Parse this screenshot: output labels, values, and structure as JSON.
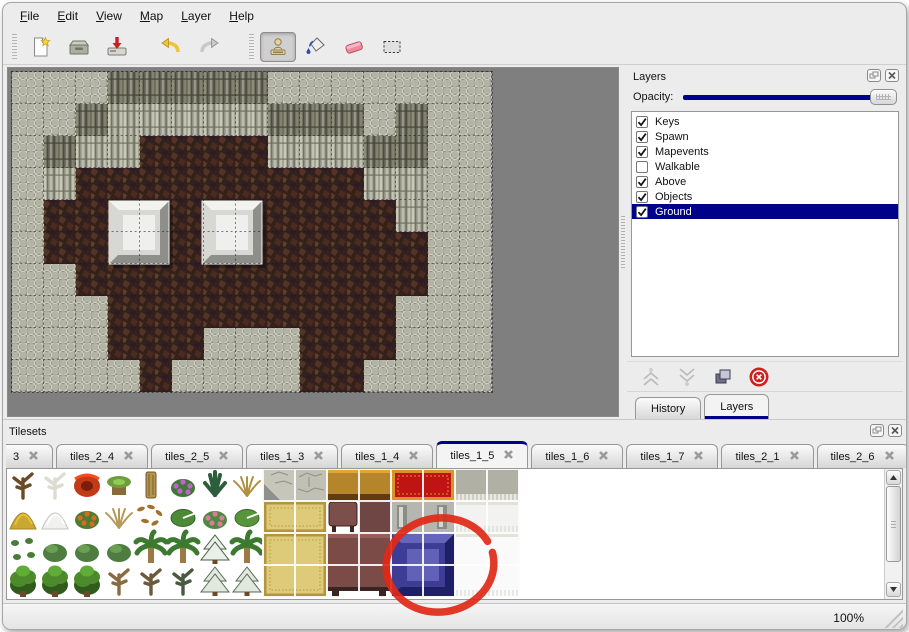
{
  "menu": {
    "items": [
      "File",
      "Edit",
      "View",
      "Map",
      "Layer",
      "Help"
    ]
  },
  "toolbar": {
    "groups": [
      [
        {
          "icon": "new-file"
        },
        {
          "icon": "open"
        },
        {
          "icon": "save"
        }
      ],
      [
        {
          "icon": "undo"
        },
        {
          "icon": "redo"
        }
      ],
      [
        {
          "icon": "stamp-tool",
          "active": true
        },
        {
          "icon": "paint-bucket-tool"
        },
        {
          "icon": "eraser-tool"
        },
        {
          "icon": "rect-select-tool"
        }
      ]
    ]
  },
  "layers_panel": {
    "title": "Layers",
    "opacity_label": "Opacity:",
    "opacity_percent": 100,
    "accent": "#00008b",
    "layers": [
      {
        "name": "Keys",
        "checked": true,
        "selected": false
      },
      {
        "name": "Spawn",
        "checked": true,
        "selected": false
      },
      {
        "name": "Mapevents",
        "checked": true,
        "selected": false
      },
      {
        "name": "Walkable",
        "checked": false,
        "selected": false
      },
      {
        "name": "Above",
        "checked": true,
        "selected": false
      },
      {
        "name": "Objects",
        "checked": true,
        "selected": false
      },
      {
        "name": "Ground",
        "checked": true,
        "selected": true
      }
    ],
    "buttons": [
      "layer-up",
      "layer-down",
      "layer-duplicate",
      "layer-delete"
    ],
    "dock_tabs": [
      {
        "label": "History",
        "active": false
      },
      {
        "label": "Layers",
        "active": true
      }
    ]
  },
  "tilesets_panel": {
    "title": "Tilesets",
    "tabs": [
      {
        "label": "3",
        "partial": true,
        "active": false
      },
      {
        "label": "tiles_2_4",
        "active": false
      },
      {
        "label": "tiles_2_5",
        "active": false
      },
      {
        "label": "tiles_1_3",
        "active": false
      },
      {
        "label": "tiles_1_4",
        "active": false
      },
      {
        "label": "tiles_1_5",
        "active": true
      },
      {
        "label": "tiles_1_6",
        "active": false
      },
      {
        "label": "tiles_1_7",
        "active": false
      },
      {
        "label": "tiles_2_1",
        "active": false
      },
      {
        "label": "tiles_2_6",
        "active": false
      }
    ]
  },
  "status_bar": {
    "zoom_level": "100%"
  },
  "map": {
    "tile_size": 32,
    "legend": {
      "S": "rough-stone-ground",
      "C": "cliff-wall",
      "D": "cliff-wall-dark",
      "B": "dark-floor"
    },
    "grid": [
      "SSSDDDDDSSSSSSS",
      "SSDCCCCCDDDSDSS",
      "SDCCBBBBCCCDDSS",
      "SCBBBBBBBBBCCSS",
      "SBBBBBBBBBBBCSS",
      "SBBBBBBBBBBBBSS",
      "SSBBBBBBBBBBBSS",
      "SSSBBBBBBBBBSSS",
      "SSSBBBSSSBBBSSS",
      "SSSSBSSSSBBSSSS"
    ],
    "blocks": [
      {
        "x": 97,
        "y": 129,
        "w": 60,
        "h": 63
      },
      {
        "x": 190,
        "y": 129,
        "w": 60,
        "h": 63
      }
    ]
  },
  "tileset": {
    "items": [
      {
        "x": 0,
        "y": 0,
        "shape": "deadtree",
        "fill": "#6b4a26"
      },
      {
        "x": 1,
        "y": 0,
        "shape": "whitetree",
        "fill": "#dcdcd2"
      },
      {
        "x": 2,
        "y": 0,
        "shape": "bigflower",
        "fill": "#c23a16",
        "fill2": "#7a1e0a"
      },
      {
        "x": 3,
        "y": 0,
        "shape": "stump",
        "fill": "#6f9c3f",
        "fill2": "#8a6a3a"
      },
      {
        "x": 4,
        "y": 0,
        "shape": "trunk",
        "fill": "#b5954e"
      },
      {
        "x": 5,
        "y": 0,
        "shape": "flowerbush",
        "fill": "#3f7a35",
        "fill2": "#c75fd4"
      },
      {
        "x": 6,
        "y": 0,
        "shape": "fern",
        "fill": "#2c5e3c"
      },
      {
        "x": 7,
        "y": 0,
        "shape": "dryplant",
        "fill": "#b08f3e"
      },
      {
        "x": 0,
        "y": 1,
        "shape": "mound",
        "fill": "#c9a733",
        "fill2": "#a8851f"
      },
      {
        "x": 1,
        "y": 1,
        "shape": "mound",
        "fill": "#f1f1ed",
        "fill2": "#c4c4c0"
      },
      {
        "x": 2,
        "y": 1,
        "shape": "flowerbush",
        "fill": "#4d7c33",
        "fill2": "#d96a22"
      },
      {
        "x": 3,
        "y": 1,
        "shape": "dryplant",
        "fill": "#b59a56"
      },
      {
        "x": 4,
        "y": 1,
        "shape": "scatter",
        "fill": "#a0702c"
      },
      {
        "x": 5,
        "y": 1,
        "shape": "pad",
        "fill": "#4c8a38"
      },
      {
        "x": 6,
        "y": 1,
        "shape": "flowerbush",
        "fill": "#4c8a44",
        "fill2": "#e07898"
      },
      {
        "x": 7,
        "y": 1,
        "shape": "pad",
        "fill": "#57953c"
      },
      {
        "x": 0,
        "y": 2,
        "shape": "sprouts",
        "fill": "#4a7c38"
      },
      {
        "x": 1,
        "y": 2,
        "shape": "bush",
        "fill": "#4f7c40"
      },
      {
        "x": 2,
        "y": 2,
        "shape": "bush",
        "fill": "#4f7c40"
      },
      {
        "x": 3,
        "y": 2,
        "shape": "bush",
        "fill": "#4f7c40"
      },
      {
        "x": 4,
        "y": 2,
        "shape": "palm",
        "fill": "#3c7a30",
        "fill2": "#9a7a46"
      },
      {
        "x": 5,
        "y": 2,
        "shape": "palm",
        "fill": "#3c7a30",
        "fill2": "#9a7a46"
      },
      {
        "x": 6,
        "y": 2,
        "shape": "snowtree",
        "fill": "#e9efe9",
        "fill2": "#49603f"
      },
      {
        "x": 7,
        "y": 2,
        "shape": "palm",
        "fill": "#3c7a30",
        "fill2": "#9a7a46"
      },
      {
        "x": 0,
        "y": 3,
        "shape": "tree",
        "fill": "#4c8a2c",
        "fill2": "#2f5c1c"
      },
      {
        "x": 1,
        "y": 3,
        "shape": "tree",
        "fill": "#4c8a2c",
        "fill2": "#2f5c1c"
      },
      {
        "x": 2,
        "y": 3,
        "shape": "tree",
        "fill": "#4c8a2c",
        "fill2": "#2f5c1c"
      },
      {
        "x": 3,
        "y": 3,
        "shape": "deadtree",
        "fill": "#8a6a40"
      },
      {
        "x": 4,
        "y": 3,
        "shape": "deadtree",
        "fill": "#6a593b"
      },
      {
        "x": 5,
        "y": 3,
        "shape": "deadtree",
        "fill": "#4a5a40"
      },
      {
        "x": 6,
        "y": 3,
        "shape": "snowtree",
        "fill": "#e0e8e0",
        "fill2": "#5a6a50"
      },
      {
        "x": 7,
        "y": 3,
        "shape": "snowtree",
        "fill": "#e0e8e0",
        "fill2": "#5a6a50"
      },
      {
        "x": 8,
        "y": 0,
        "shape": "stonecorner",
        "fill": "#c6c6ba"
      },
      {
        "x": 9,
        "y": 0,
        "shape": "stone",
        "fill": "#c0c0b4"
      },
      {
        "x": 10,
        "y": 0,
        "w": 2,
        "shape": "woodtop",
        "fill": "#b5852c"
      },
      {
        "x": 12,
        "y": 0,
        "w": 2,
        "shape": "carpetred",
        "fill": "#c01414",
        "fill2": "#d89428"
      },
      {
        "x": 14,
        "y": 0,
        "w": 2,
        "shape": "graytop",
        "fill": "#b0b0a4"
      },
      {
        "x": 8,
        "y": 1,
        "w": 2,
        "shape": "carpettan",
        "fill": "#ddcb79",
        "fill2": "#b3953f"
      },
      {
        "x": 10,
        "y": 1,
        "shape": "stooltop",
        "fill": "#7c4f4b"
      },
      {
        "x": 11,
        "y": 1,
        "shape": "flat",
        "fill": "#6f4643"
      },
      {
        "x": 12,
        "y": 1,
        "w": 2,
        "shape": "frame",
        "fill": "#b6b6b0"
      },
      {
        "x": 14,
        "y": 1,
        "w": 2,
        "shape": "cloth",
        "fill": "#f2f2f0"
      },
      {
        "x": 8,
        "y": 2,
        "w": 2,
        "h": 2,
        "shape": "carpettan",
        "fill": "#ddcb79",
        "fill2": "#b3953f"
      },
      {
        "x": 10,
        "y": 2,
        "w": 2,
        "h": 2,
        "shape": "table",
        "fill": "#7a4b47",
        "fill2": "#3a2422"
      },
      {
        "x": 12,
        "y": 2,
        "w": 2,
        "h": 2,
        "shape": "blueblock",
        "fill": "#3d3d95",
        "fill2": "#1f1f66",
        "fill3": "#6565bb"
      },
      {
        "x": 14,
        "y": 2,
        "w": 2,
        "h": 2,
        "shape": "cloth",
        "fill": "#fafafa"
      }
    ]
  },
  "annotation": {
    "shape": "ellipse",
    "color": "#df2817",
    "cx": 69,
    "cy": 58,
    "rx": 54,
    "ry": 47
  }
}
